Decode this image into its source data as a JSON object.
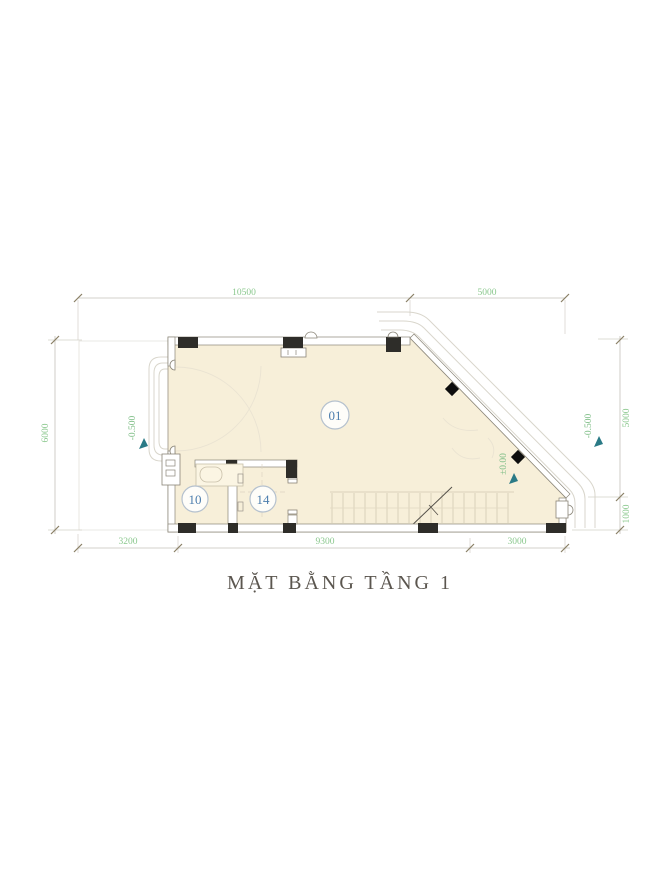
{
  "title": "MẶT BẰNG TẦNG 1",
  "dimensions": {
    "top": [
      "10500",
      "5000"
    ],
    "bottom": [
      "3200",
      "9300",
      "3000"
    ],
    "left": [
      "6000"
    ],
    "right": [
      "5000",
      "1000"
    ]
  },
  "elevations": {
    "left": "-0.500",
    "center": "±0.00",
    "right": "-0.500"
  },
  "rooms": [
    {
      "id": "01"
    },
    {
      "id": "10"
    },
    {
      "id": "14"
    }
  ],
  "colors": {
    "floor_fill": "#f7efd9",
    "wall_line": "#8a8578",
    "column_fill": "#2e2d29",
    "dimension_text": "#8bc88e",
    "dimension_line": "#c4c1ba",
    "tick_mark": "#8a7f66",
    "elevation_arrow": "#2a7a86",
    "room_label_text": "#4c7dad",
    "room_label_border": "#b5c1ce",
    "title_color": "#5b564f",
    "ramp_line": "#d9d6cc"
  }
}
